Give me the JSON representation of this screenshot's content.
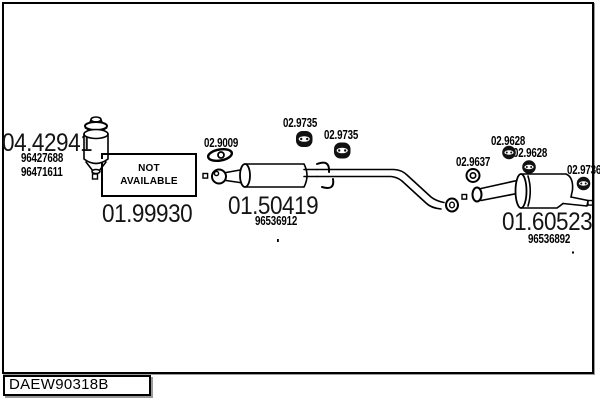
{
  "page": {
    "background": "#ffffff",
    "line_color": "#000000",
    "text_color": "#141414"
  },
  "footer": {
    "diagram_code": "DAEW90318B"
  },
  "parts": {
    "catalyst": {
      "code": "04.42941",
      "oem_numbers": [
        "96427688",
        "96471611"
      ]
    },
    "front_pipe": {
      "code": "01.99930",
      "availability_line1": "NOT",
      "availability_line2": "AVAILABLE"
    },
    "front_gasket": {
      "code": "02.9009"
    },
    "mid_hanger_1": {
      "code": "02.9735"
    },
    "mid_hanger_2": {
      "code": "02.9735"
    },
    "center_muffler": {
      "code": "01.50419",
      "oem_number": "96536912"
    },
    "rear_gasket": {
      "code": "02.9637"
    },
    "rear_hanger_1": {
      "code": "02.9628"
    },
    "rear_hanger_2": {
      "code": "02.9628"
    },
    "tail_hanger": {
      "code": "02.9736"
    },
    "rear_muffler": {
      "code": "01.60523",
      "oem_number": "96536892"
    }
  }
}
